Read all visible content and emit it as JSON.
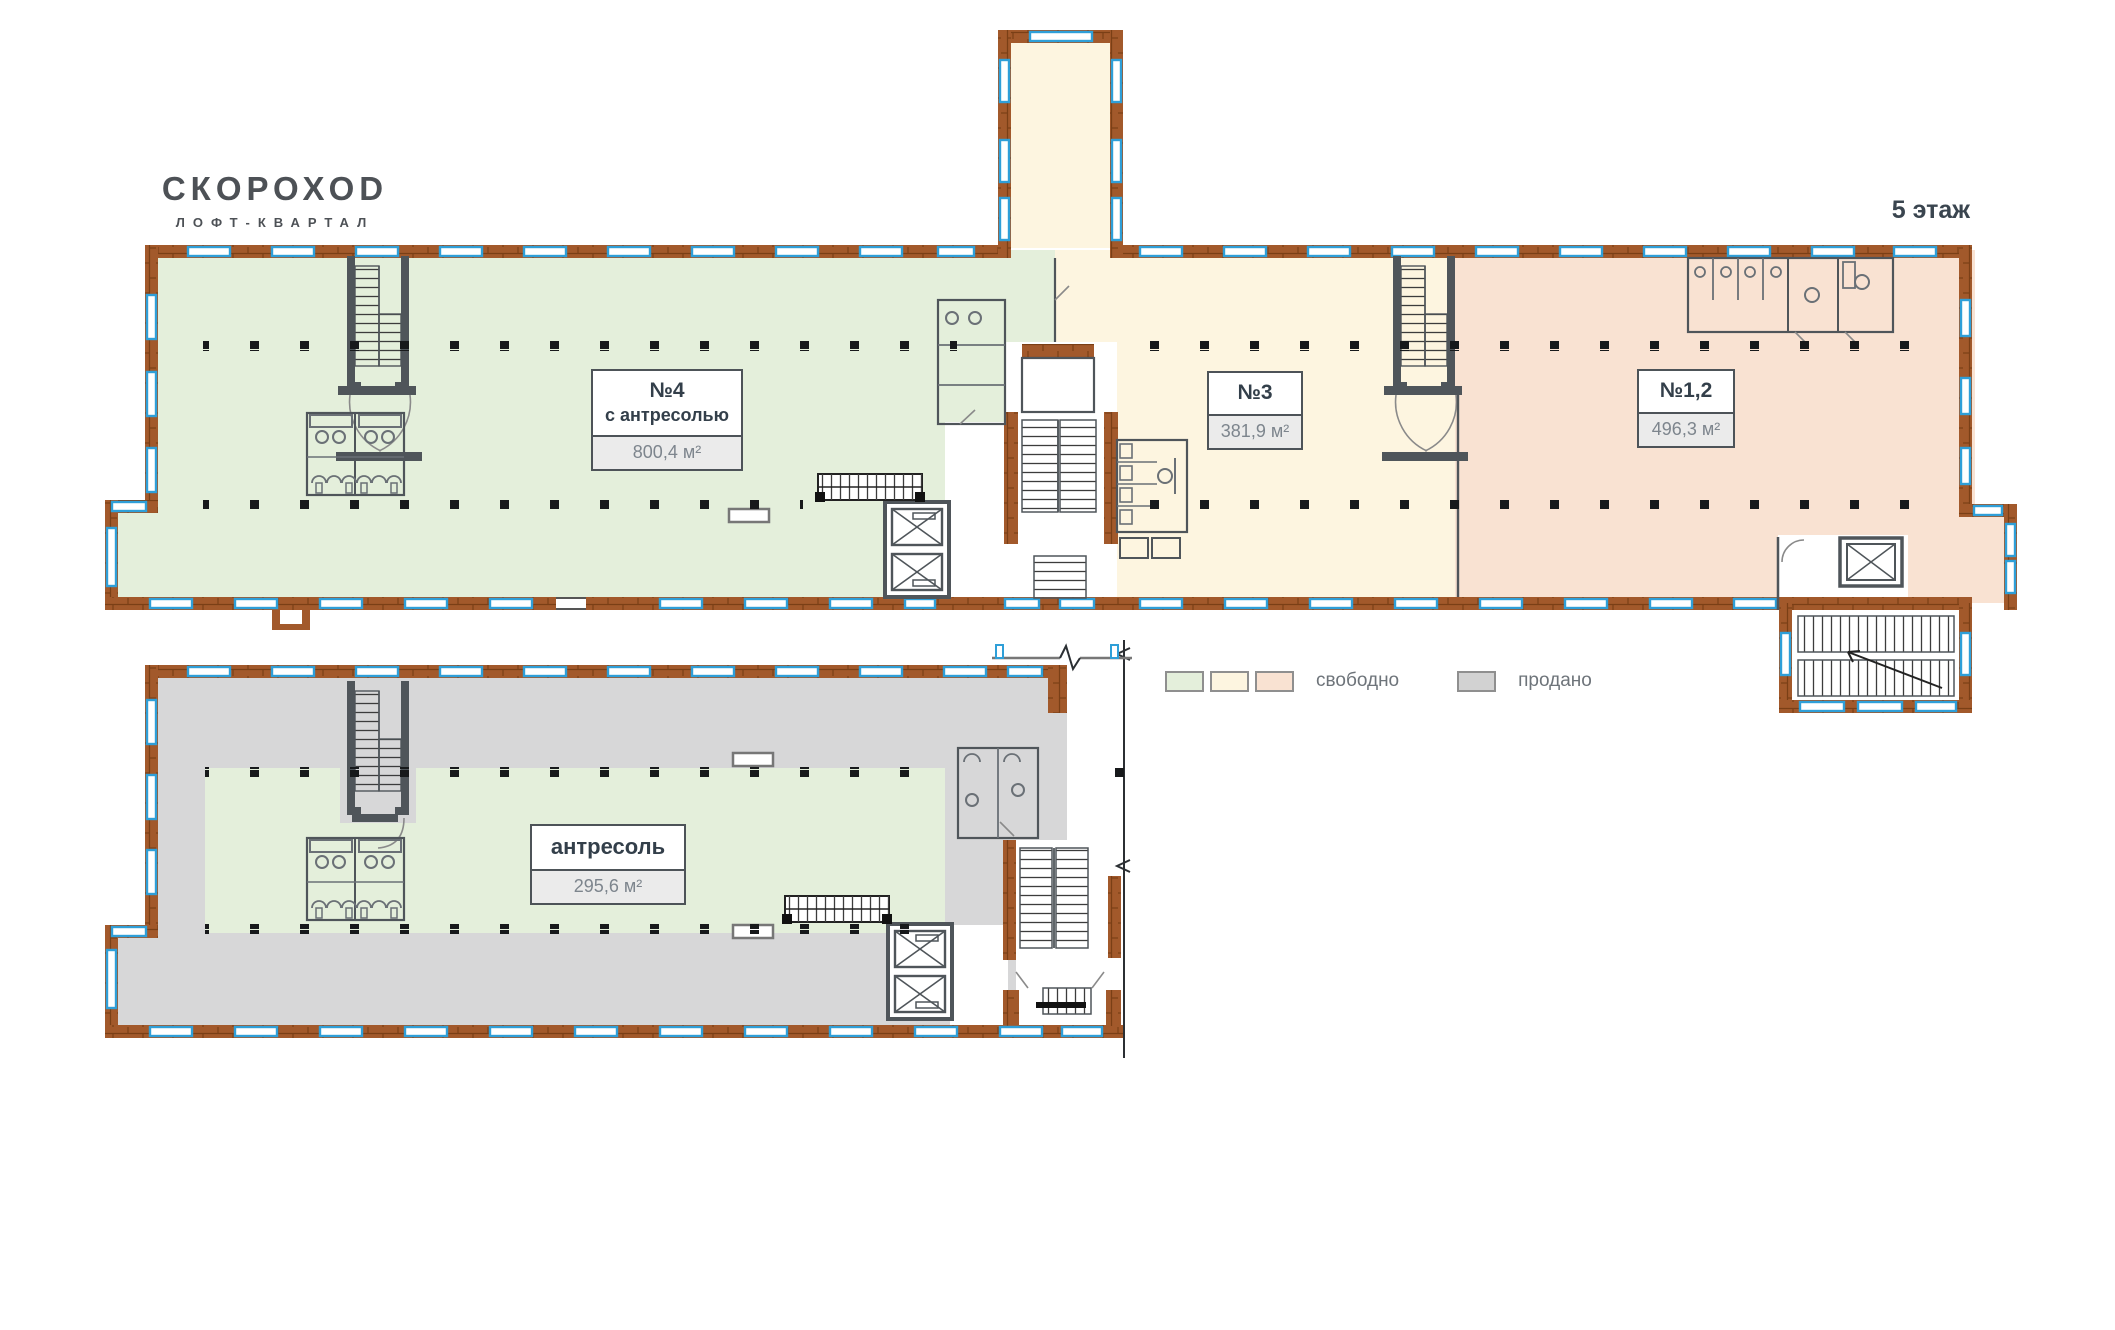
{
  "brand": {
    "name": "СКОРОХОD",
    "tagline": "ЛОФТ-КВАРТАЛ"
  },
  "floor": {
    "label": "5 этаж"
  },
  "units": [
    {
      "name": "№4",
      "subtitle": "с антресолью",
      "area": "800,4 м²",
      "status": "свободно"
    },
    {
      "name": "№3",
      "subtitle": "",
      "area": "381,9 м²",
      "status": "свободно"
    },
    {
      "name": "№1,2",
      "subtitle": "",
      "area": "496,3 м²",
      "status": "свободно"
    },
    {
      "name": "антресоль",
      "subtitle": "",
      "area": "295,6 м²",
      "status": "свободно"
    }
  ],
  "legend": {
    "available_label": "свободно",
    "sold_label": "продано",
    "available_colors": [
      "#e4efdb",
      "#fdf5e0",
      "#f9e2d2"
    ],
    "sold_color": "#d2d2d2"
  },
  "colors": {
    "zone_green": "#e4efdb",
    "zone_cream": "#fdf5e0",
    "zone_peach": "#f9e2d2",
    "zone_sold": "#d7d7d8",
    "wall_brick": "#a2592b",
    "window_blue": "#2f9fd8",
    "ink": "#4f555a"
  }
}
